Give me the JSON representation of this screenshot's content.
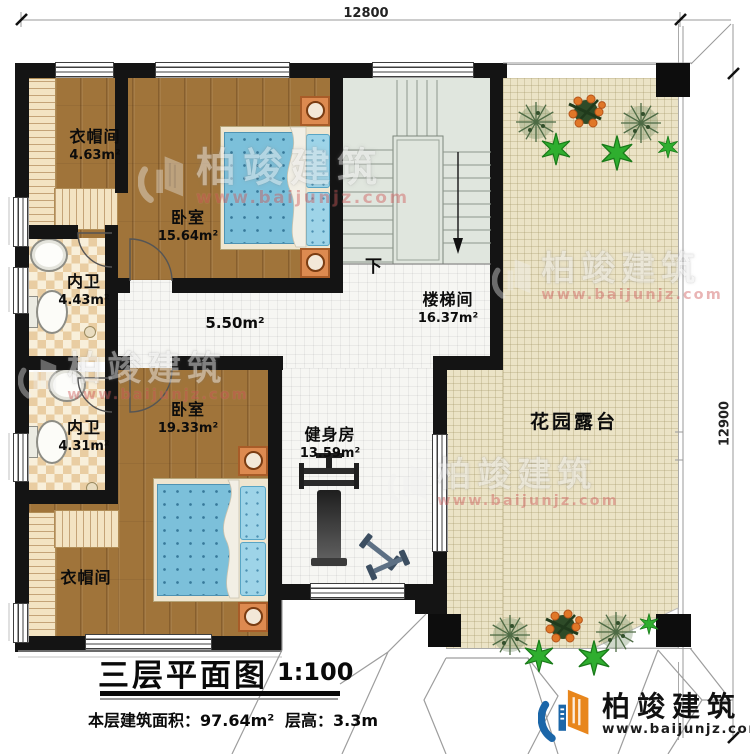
{
  "dimensions": {
    "top": "12800",
    "right": "12900"
  },
  "rooms": {
    "closet_top": {
      "name": "衣帽间",
      "area": "4.63m²"
    },
    "bedroom_top": {
      "name": "卧室",
      "area": "15.64m²"
    },
    "bath_top": {
      "name": "内卫",
      "area": "4.43m²"
    },
    "hall": {
      "area": "5.50m²"
    },
    "bath_bottom": {
      "name": "内卫",
      "area": "4.31m²"
    },
    "bedroom_bottom": {
      "name": "卧室",
      "area": "19.33m²"
    },
    "closet_bottom": {
      "name": "衣帽间"
    },
    "stairwell": {
      "name": "楼梯间",
      "area": "16.37m²",
      "direction": "下"
    },
    "gym": {
      "name": "健身房",
      "area": "13.59m²"
    },
    "terrace": {
      "name": "花园露台"
    }
  },
  "title": {
    "main": "三层平面图",
    "scale": "1:100",
    "floor_area": "本层建筑面积：97.64m²",
    "floor_height": "层高：3.3m"
  },
  "branding": {
    "company": "柏竣建筑",
    "website": "www.baijunjz.com"
  },
  "colors": {
    "wall": "#141414",
    "wood_floor": "#a0743a",
    "terrace_floor": "#ebe3c6",
    "mattress_blue": "#7cc0da",
    "nightstand_orange": "#dd8a50",
    "logo_blue": "#1b66a8",
    "logo_orange": "#e8861c"
  }
}
